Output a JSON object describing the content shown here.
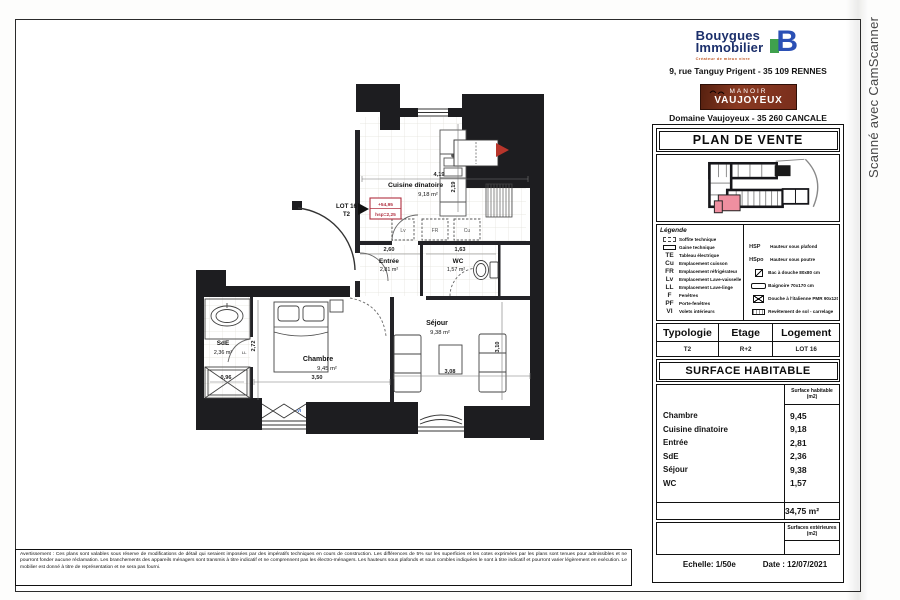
{
  "watermark": "Scanné avec CamScanner",
  "header": {
    "brand_line1": "Bouygues",
    "brand_line2": "Immobilier",
    "brand_tagline": "Créateur de mieux vivre",
    "brand_b": "B",
    "address": "9, rue Tanguy Prigent - 35 109 RENNES",
    "estate_line1": "MANOIR",
    "estate_line2": "VAUJOYEUX",
    "estate_address": "Domaine Vaujoyeux - 35 260 CANCALE",
    "doc_title": "PLAN DE VENTE"
  },
  "plan": {
    "lot_label": "LOT 16",
    "lot_type": "T2",
    "stamp_line1": "+54,95",
    "stamp_line2": "hsp=2,25",
    "rooms": {
      "cuisine": {
        "name": "Cuisine dînatoire",
        "area": "9,18 m²"
      },
      "entree": {
        "name": "Entrée",
        "area": "2,81 m²"
      },
      "wc": {
        "name": "WC",
        "area": "1,57 m²"
      },
      "sde": {
        "name": "SdE",
        "area": "2,36 m²"
      },
      "chambre": {
        "name": "Chambre",
        "area": "9,45 m²"
      },
      "sejour": {
        "name": "Séjour",
        "area": "9,38 m²"
      }
    },
    "dims": {
      "cuisine_w": "4,19",
      "cuisine_d": "2,19",
      "entree_w": "2,60",
      "wc_w": "1,63",
      "chambre_w": "3,50",
      "chambre_d": "2,72",
      "sejour_w": "3,08",
      "sejour_d": "3,10",
      "shower_w": "0,96"
    },
    "appliances": {
      "left": "Lv",
      "mid": "FR",
      "right": "Cu"
    },
    "marks": {
      "vi": "VI",
      "ll": "LL"
    }
  },
  "legend": {
    "title": "Légende",
    "left": [
      {
        "label": "Soffite technique"
      },
      {
        "label": "Gaine technique"
      },
      {
        "code": "TE",
        "label": "Tableau électrique"
      },
      {
        "code": "Cu",
        "label": "Emplacement cuisson"
      },
      {
        "code": "FR",
        "label": "Emplacement réfrigérateur"
      },
      {
        "code": "Lv",
        "label": "Emplacement Lave-vaisselle"
      },
      {
        "code": "LL",
        "label": "Emplacement Lave-linge"
      },
      {
        "code": "F",
        "label": "Fenêtres"
      },
      {
        "code": "PF",
        "label": "Porte-fenêtres"
      },
      {
        "code": "VI",
        "label": "Volets intérieurs"
      }
    ],
    "right": [
      {
        "code": "HSP",
        "label": "Hauteur sous plafond"
      },
      {
        "code": "HSpo",
        "label": "Hauteur sous poutre"
      },
      {
        "label": "Bac à douche 80x80 cm"
      },
      {
        "label": "Baignoire 70x170 cm"
      },
      {
        "label": "Douche à l'italienne PMR 90x120 cm"
      },
      {
        "label": "Revêtement de sol - carrelage"
      }
    ]
  },
  "unit_table": {
    "h1": "Typologie",
    "h2": "Etage",
    "h3": "Logement",
    "v1": "T2",
    "v2": "R+2",
    "v3": "LOT 16"
  },
  "surface": {
    "title": "SURFACE HABITABLE",
    "col_header_1": "Surface habitable",
    "col_header_2": "(m2)",
    "rows": [
      {
        "room": "Chambre",
        "value": "9,45"
      },
      {
        "room": "Cuisine dînatoire",
        "value": "9,18"
      },
      {
        "room": "Entrée",
        "value": "2,81"
      },
      {
        "room": "SdE",
        "value": "2,36"
      },
      {
        "room": "Séjour",
        "value": "9,38"
      },
      {
        "room": "WC",
        "value": "1,57"
      }
    ],
    "total": "34,75 m²",
    "ext_header_1": "Surfaces extérieures",
    "ext_header_2": "(m2)"
  },
  "footer": {
    "scale": "Echelle: 1/50e",
    "date": "Date : 12/07/2021"
  },
  "disclaimer": "Avertissement : Ces plans sont valables sous réserve de modifications de détail qui seraient imposées par des impératifs techniques en cours de construction. Les différences de 5% sur les superficies et les cotes exprimées par les plans sont tenues pour admissibles et ne pourront fonder aucune réclamation. Les branchements des appareils ménagers sont transmis à titre indicatif et ne comprennent pas les électro-ménagers. Les hauteurs sous plafonds et sous combles indiquées le sont à titre indicatif et pourront varier légèrement en exécution. Le mobilier est donné à titre de représentation et ne sera pas fourni."
}
